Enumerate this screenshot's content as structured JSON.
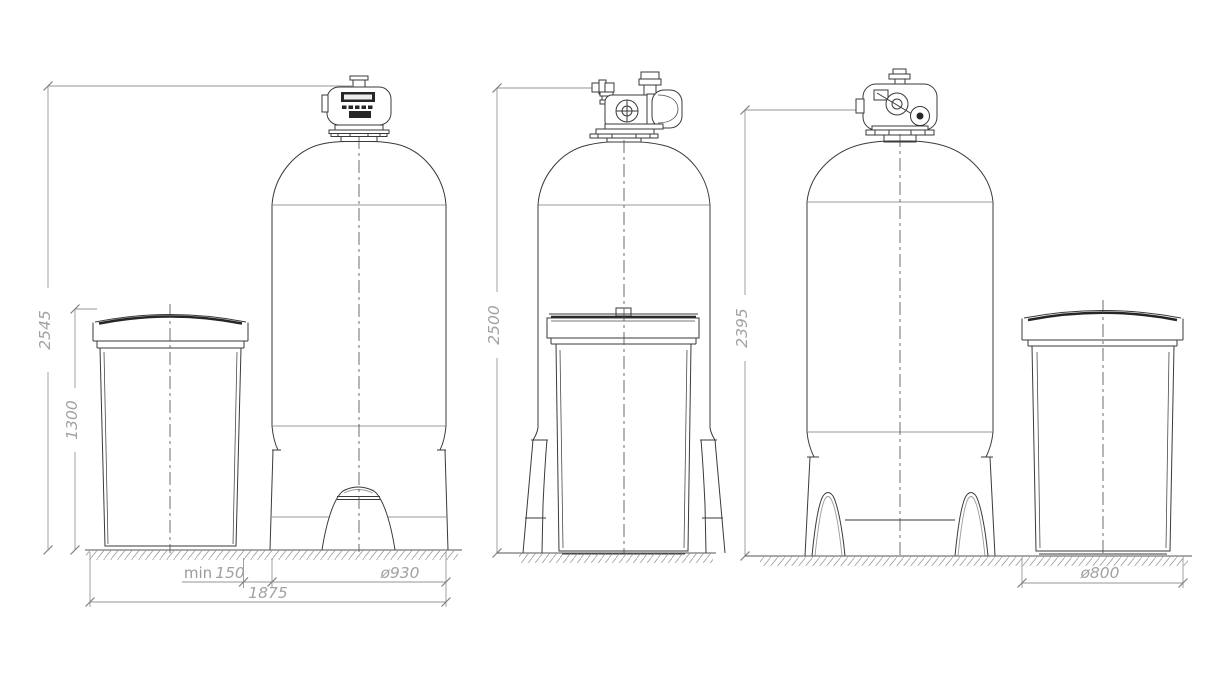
{
  "drawing": {
    "background": "#ffffff",
    "outline_color": "#3a3a3a",
    "dimension_color": "#a2a2a2",
    "views": {
      "left": {
        "overall_height": "2545",
        "brine_tank_height": "1300",
        "clearance_label": "min",
        "clearance_value": "150",
        "tank_diameter": "ø930",
        "overall_width": "1875"
      },
      "middle": {
        "overall_height": "2500"
      },
      "right": {
        "overall_height": "2395",
        "brine_tank_diameter": "ø800"
      }
    }
  }
}
